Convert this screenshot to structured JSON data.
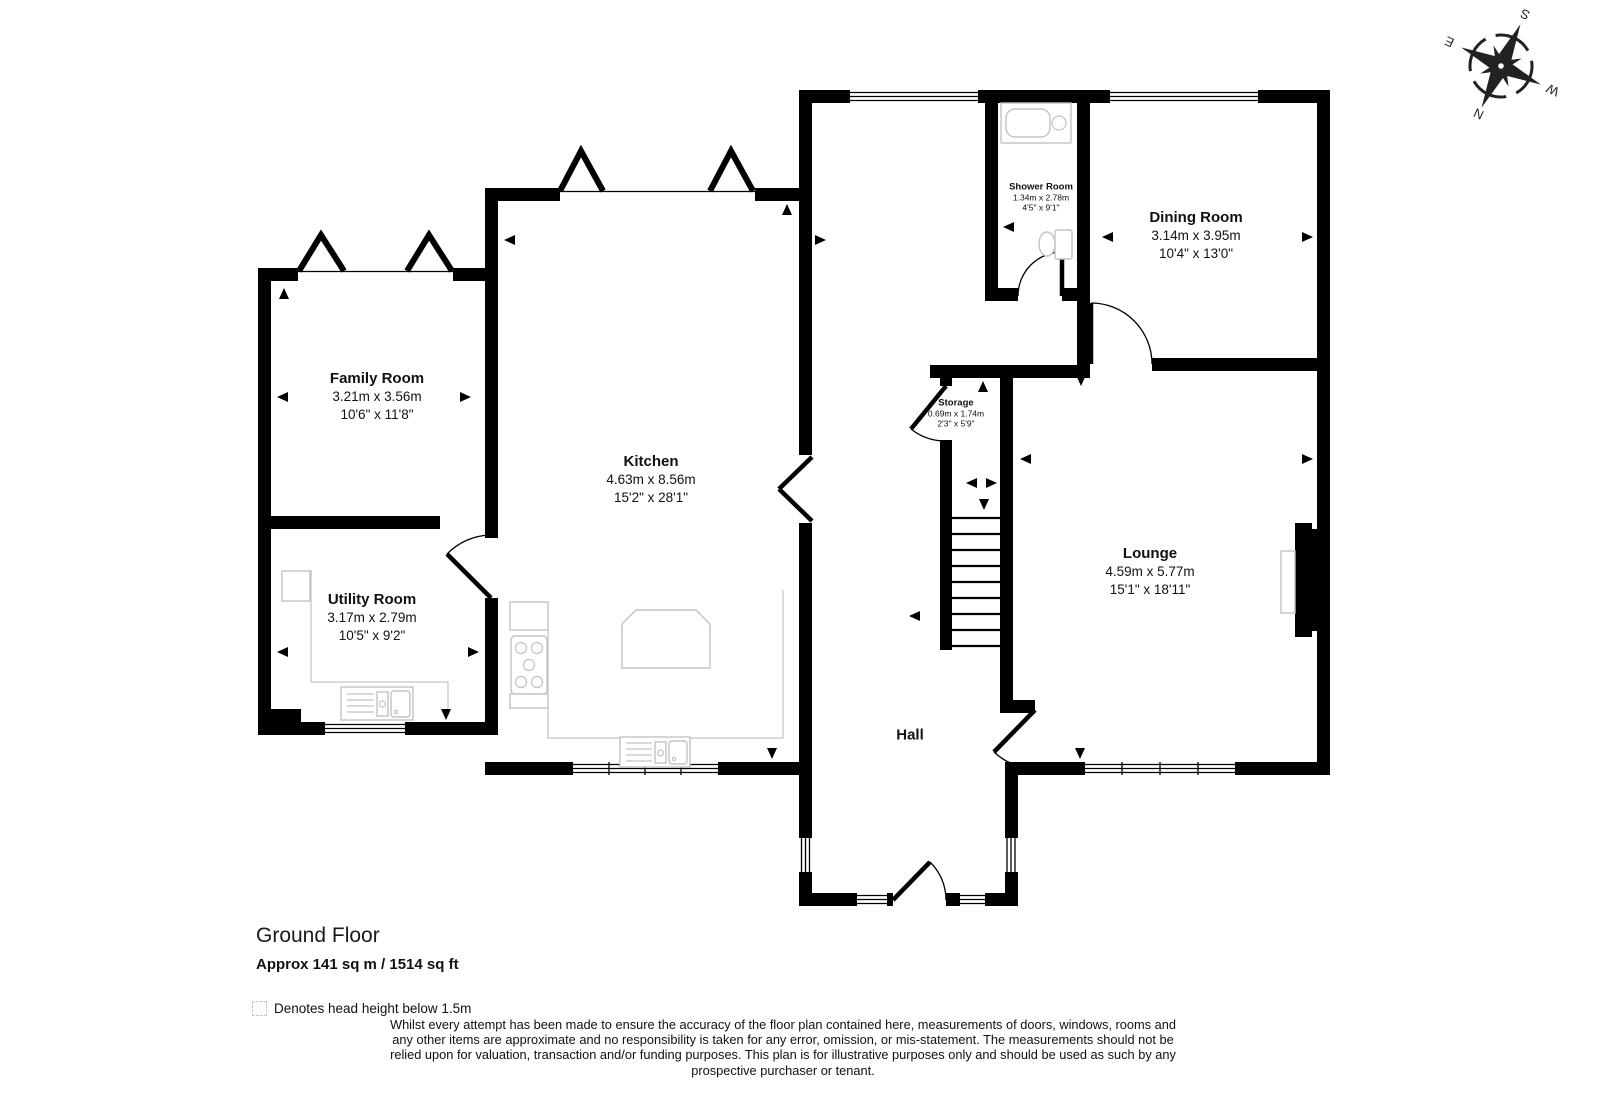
{
  "title": {
    "floor": "Ground Floor",
    "area": "Approx 141 sq m / 1514 sq ft"
  },
  "legend": {
    "note": "Denotes head height below 1.5m"
  },
  "disclaimer": {
    "text": "Whilst every attempt has been made to ensure the accuracy of the floor plan contained here, measurements of doors, windows, rooms and any other items are approximate and no responsibility is taken for any error, omission, or mis-statement. The measurements should not be relied upon for valuation, transaction and/or funding purposes. This plan is for illustrative purposes only and should be used as such by any prospective purchaser or tenant."
  },
  "compass": {
    "n": "N",
    "e": "E",
    "s": "S",
    "w": "W"
  },
  "rooms": [
    {
      "id": "family-room",
      "name": "Family Room",
      "metric": "3.21m x 3.56m",
      "imperial": "10'6\" x 11'8\""
    },
    {
      "id": "kitchen",
      "name": "Kitchen",
      "metric": "4.63m x 8.56m",
      "imperial": "15'2\" x 28'1\""
    },
    {
      "id": "utility-room",
      "name": "Utility Room",
      "metric": "3.17m x 2.79m",
      "imperial": "10'5\" x 9'2\""
    },
    {
      "id": "shower-room",
      "name": "Shower Room",
      "metric": "1.34m x 2.78m",
      "imperial": "4'5\" x 9'1\""
    },
    {
      "id": "dining-room",
      "name": "Dining Room",
      "metric": "3.14m x 3.95m",
      "imperial": "10'4\" x 13'0\""
    },
    {
      "id": "storage",
      "name": "Storage",
      "metric": "0.69m x 1.74m",
      "imperial": "2'3\" x 5'9\""
    },
    {
      "id": "lounge",
      "name": "Lounge",
      "metric": "4.59m x 5.77m",
      "imperial": "15'1\" x 18'11\""
    },
    {
      "id": "hall",
      "name": "Hall",
      "metric": "",
      "imperial": ""
    }
  ]
}
